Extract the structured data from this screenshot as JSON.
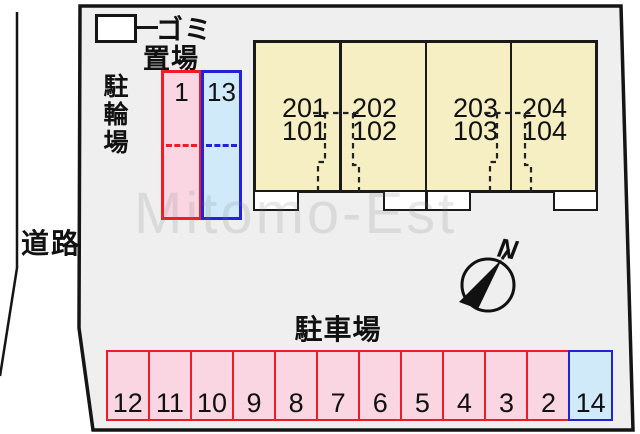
{
  "watermark": "Mitomo-Est",
  "road": {
    "label": "道路"
  },
  "garbage": {
    "label_line1": "ゴミ",
    "label_line2": "置場"
  },
  "bicycle_area": {
    "label": "駐輪場",
    "spaces": [
      {
        "id": "1",
        "type": "pink"
      },
      {
        "id": "13",
        "type": "blue"
      }
    ]
  },
  "building": {
    "units": [
      {
        "upper": "201",
        "lower": "101"
      },
      {
        "upper": "202",
        "lower": "102"
      },
      {
        "upper": "203",
        "lower": "103"
      },
      {
        "upper": "204",
        "lower": "104"
      }
    ]
  },
  "parking": {
    "label": "駐車場",
    "spaces": [
      {
        "id": "12",
        "type": "pink"
      },
      {
        "id": "11",
        "type": "pink"
      },
      {
        "id": "10",
        "type": "pink"
      },
      {
        "id": "9",
        "type": "pink"
      },
      {
        "id": "8",
        "type": "pink"
      },
      {
        "id": "7",
        "type": "pink"
      },
      {
        "id": "6",
        "type": "pink"
      },
      {
        "id": "5",
        "type": "pink"
      },
      {
        "id": "4",
        "type": "pink"
      },
      {
        "id": "3",
        "type": "pink"
      },
      {
        "id": "2",
        "type": "pink"
      },
      {
        "id": "14",
        "type": "blue"
      }
    ]
  },
  "compass": {
    "label": "N"
  },
  "colors": {
    "lot_fill": "#efefef",
    "building_fill": "#f5efc3",
    "pink_fill": "#fad6e2",
    "light_blue_fill": "#d0eafa",
    "red_border": "#ee1c25",
    "blue_border": "#2222dd",
    "line": "#1a1a1a"
  }
}
